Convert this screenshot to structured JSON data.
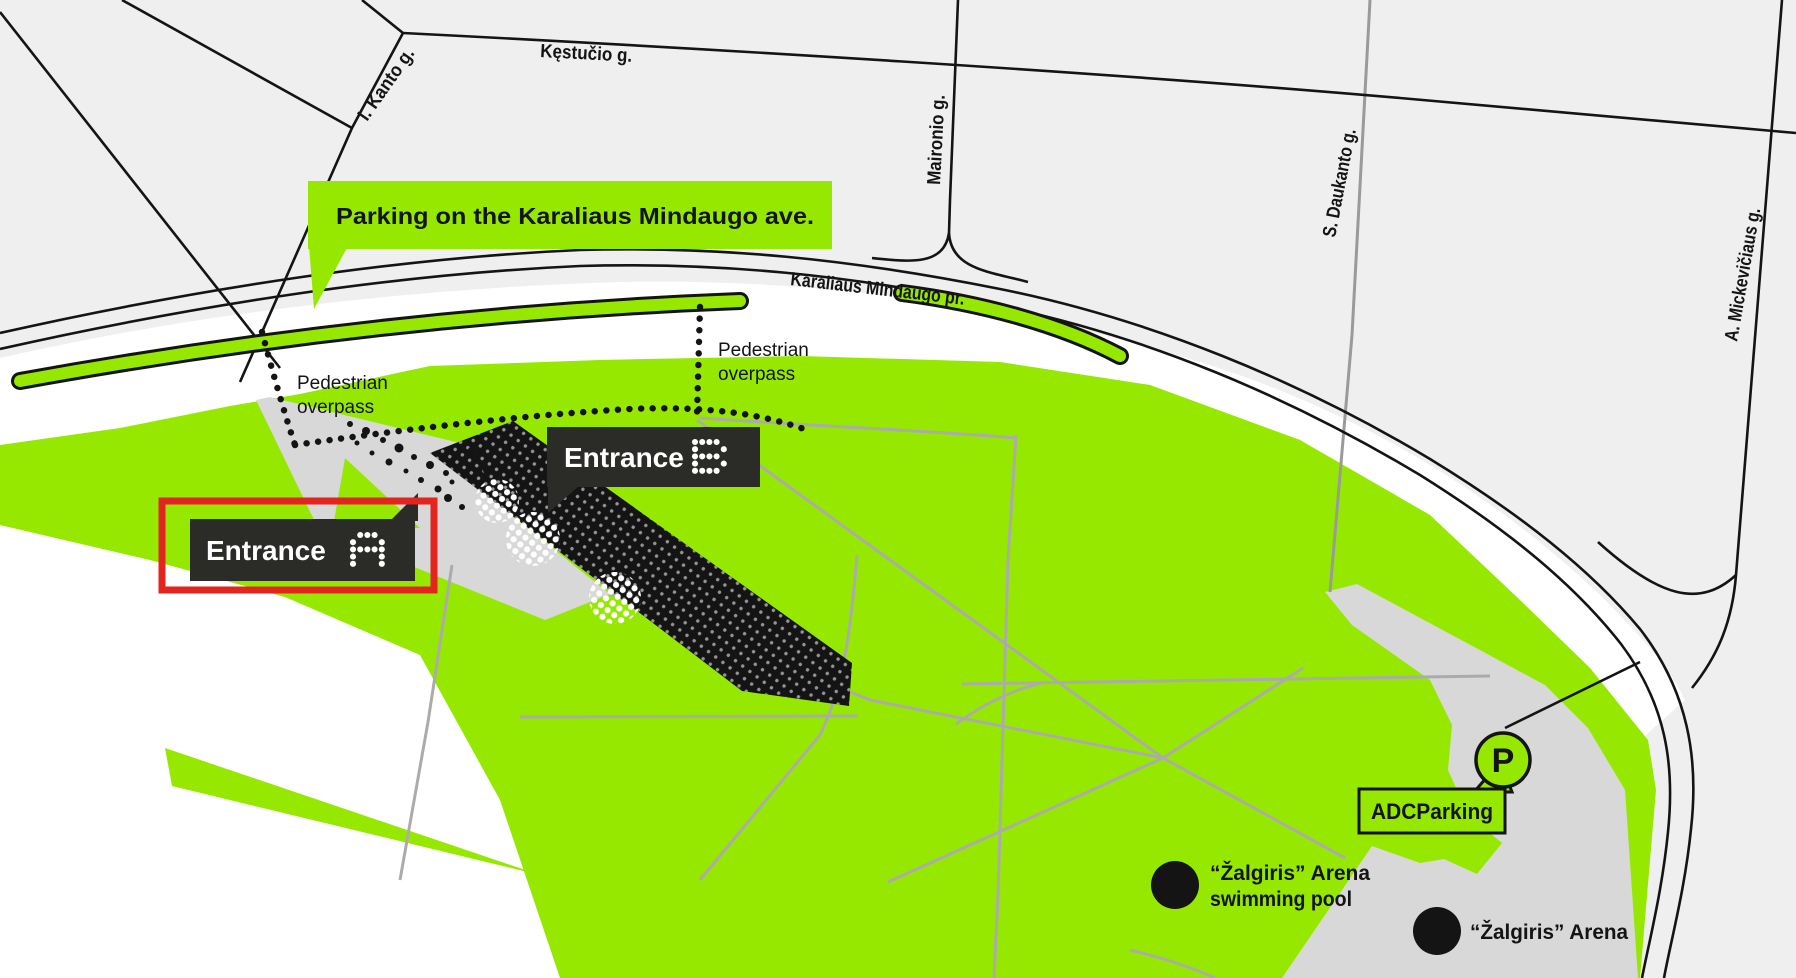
{
  "colors": {
    "lime": "#96E800",
    "dark": "#2B2B27",
    "red": "#E3251F",
    "bg": "#EFEFEF",
    "white_area": "#FFFFFF",
    "plaza_gray": "#D8D8D8",
    "path_gray": "#ABABAB",
    "road_black": "#141414"
  },
  "streets": {
    "kestucio": "Kęstučio g.",
    "kanto": "I. Kanto g.",
    "maironio": "Maironio g.",
    "daukanto": "S. Daukanto g.",
    "mickeviciaus": "A. Mickevičiaus g.",
    "mindaugo": "Karaliaus Mindaugo pr."
  },
  "banner": {
    "label": "Parking on the Karaliaus Mindaugo ave."
  },
  "overpass_left": {
    "line1": "Pedestrian",
    "line2": "overpass"
  },
  "overpass_right": {
    "line1": "Pedestrian",
    "line2": "overpass"
  },
  "entrance_a": {
    "label": "Entrance",
    "letter": "A",
    "highlighted": "true"
  },
  "entrance_b": {
    "label": "Entrance",
    "letter": "B"
  },
  "adc_parking": {
    "label": "ADCParking",
    "icon_letter": "P"
  },
  "pois": {
    "pool": {
      "line1": "“Žalgiris” Arena",
      "line2": "swimming pool"
    },
    "arena": {
      "label": "“Žalgiris” Arena"
    }
  }
}
